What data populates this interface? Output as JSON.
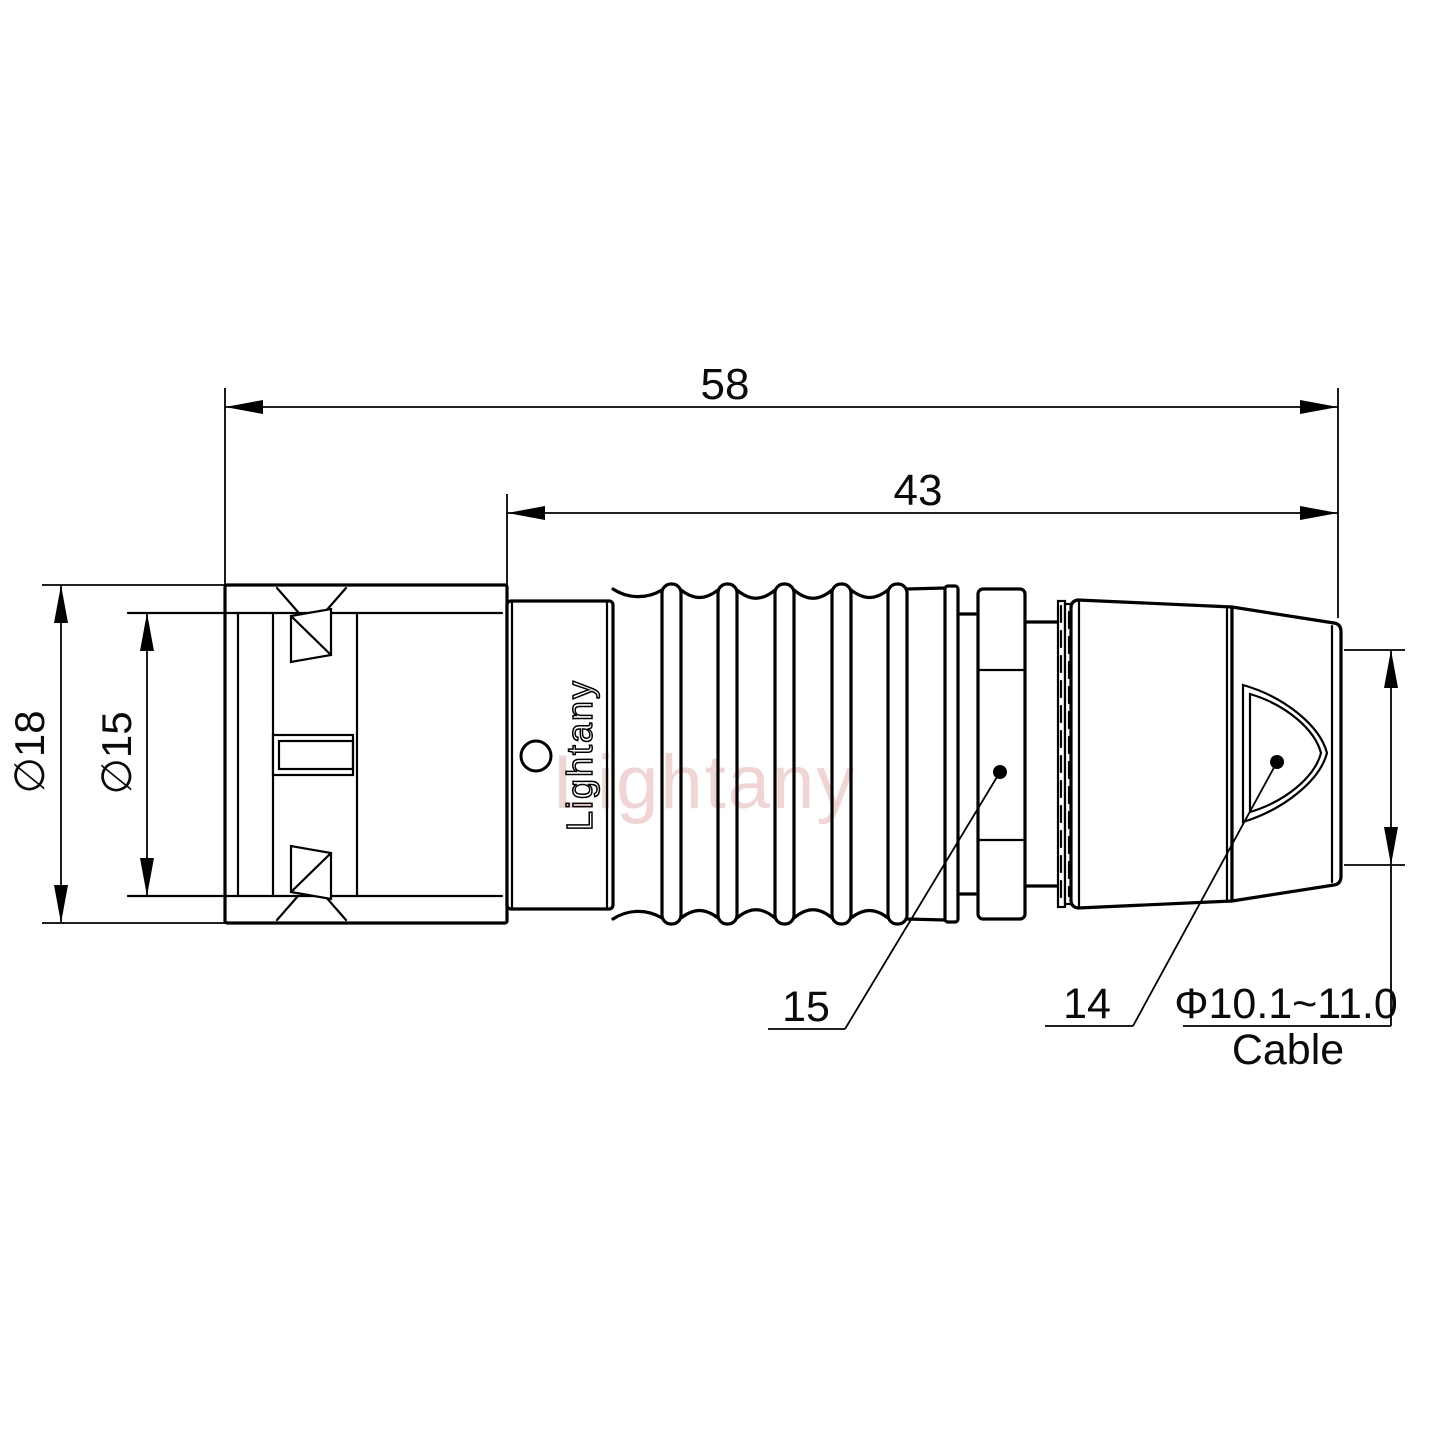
{
  "drawing": {
    "dimensions": {
      "overall_length": "58",
      "body_length": "43",
      "outer_diameter": "∅18",
      "inner_diameter": "∅15",
      "cable_range": "Φ10.1~11.0",
      "cable_word": "Cable"
    },
    "part_labels": {
      "coupling_nut": "15",
      "backshell": "14"
    },
    "branding": {
      "logo": "Lightany",
      "watermark": "Lightany"
    },
    "colors": {
      "line": "#000000",
      "watermark": "#d98c8c"
    }
  }
}
